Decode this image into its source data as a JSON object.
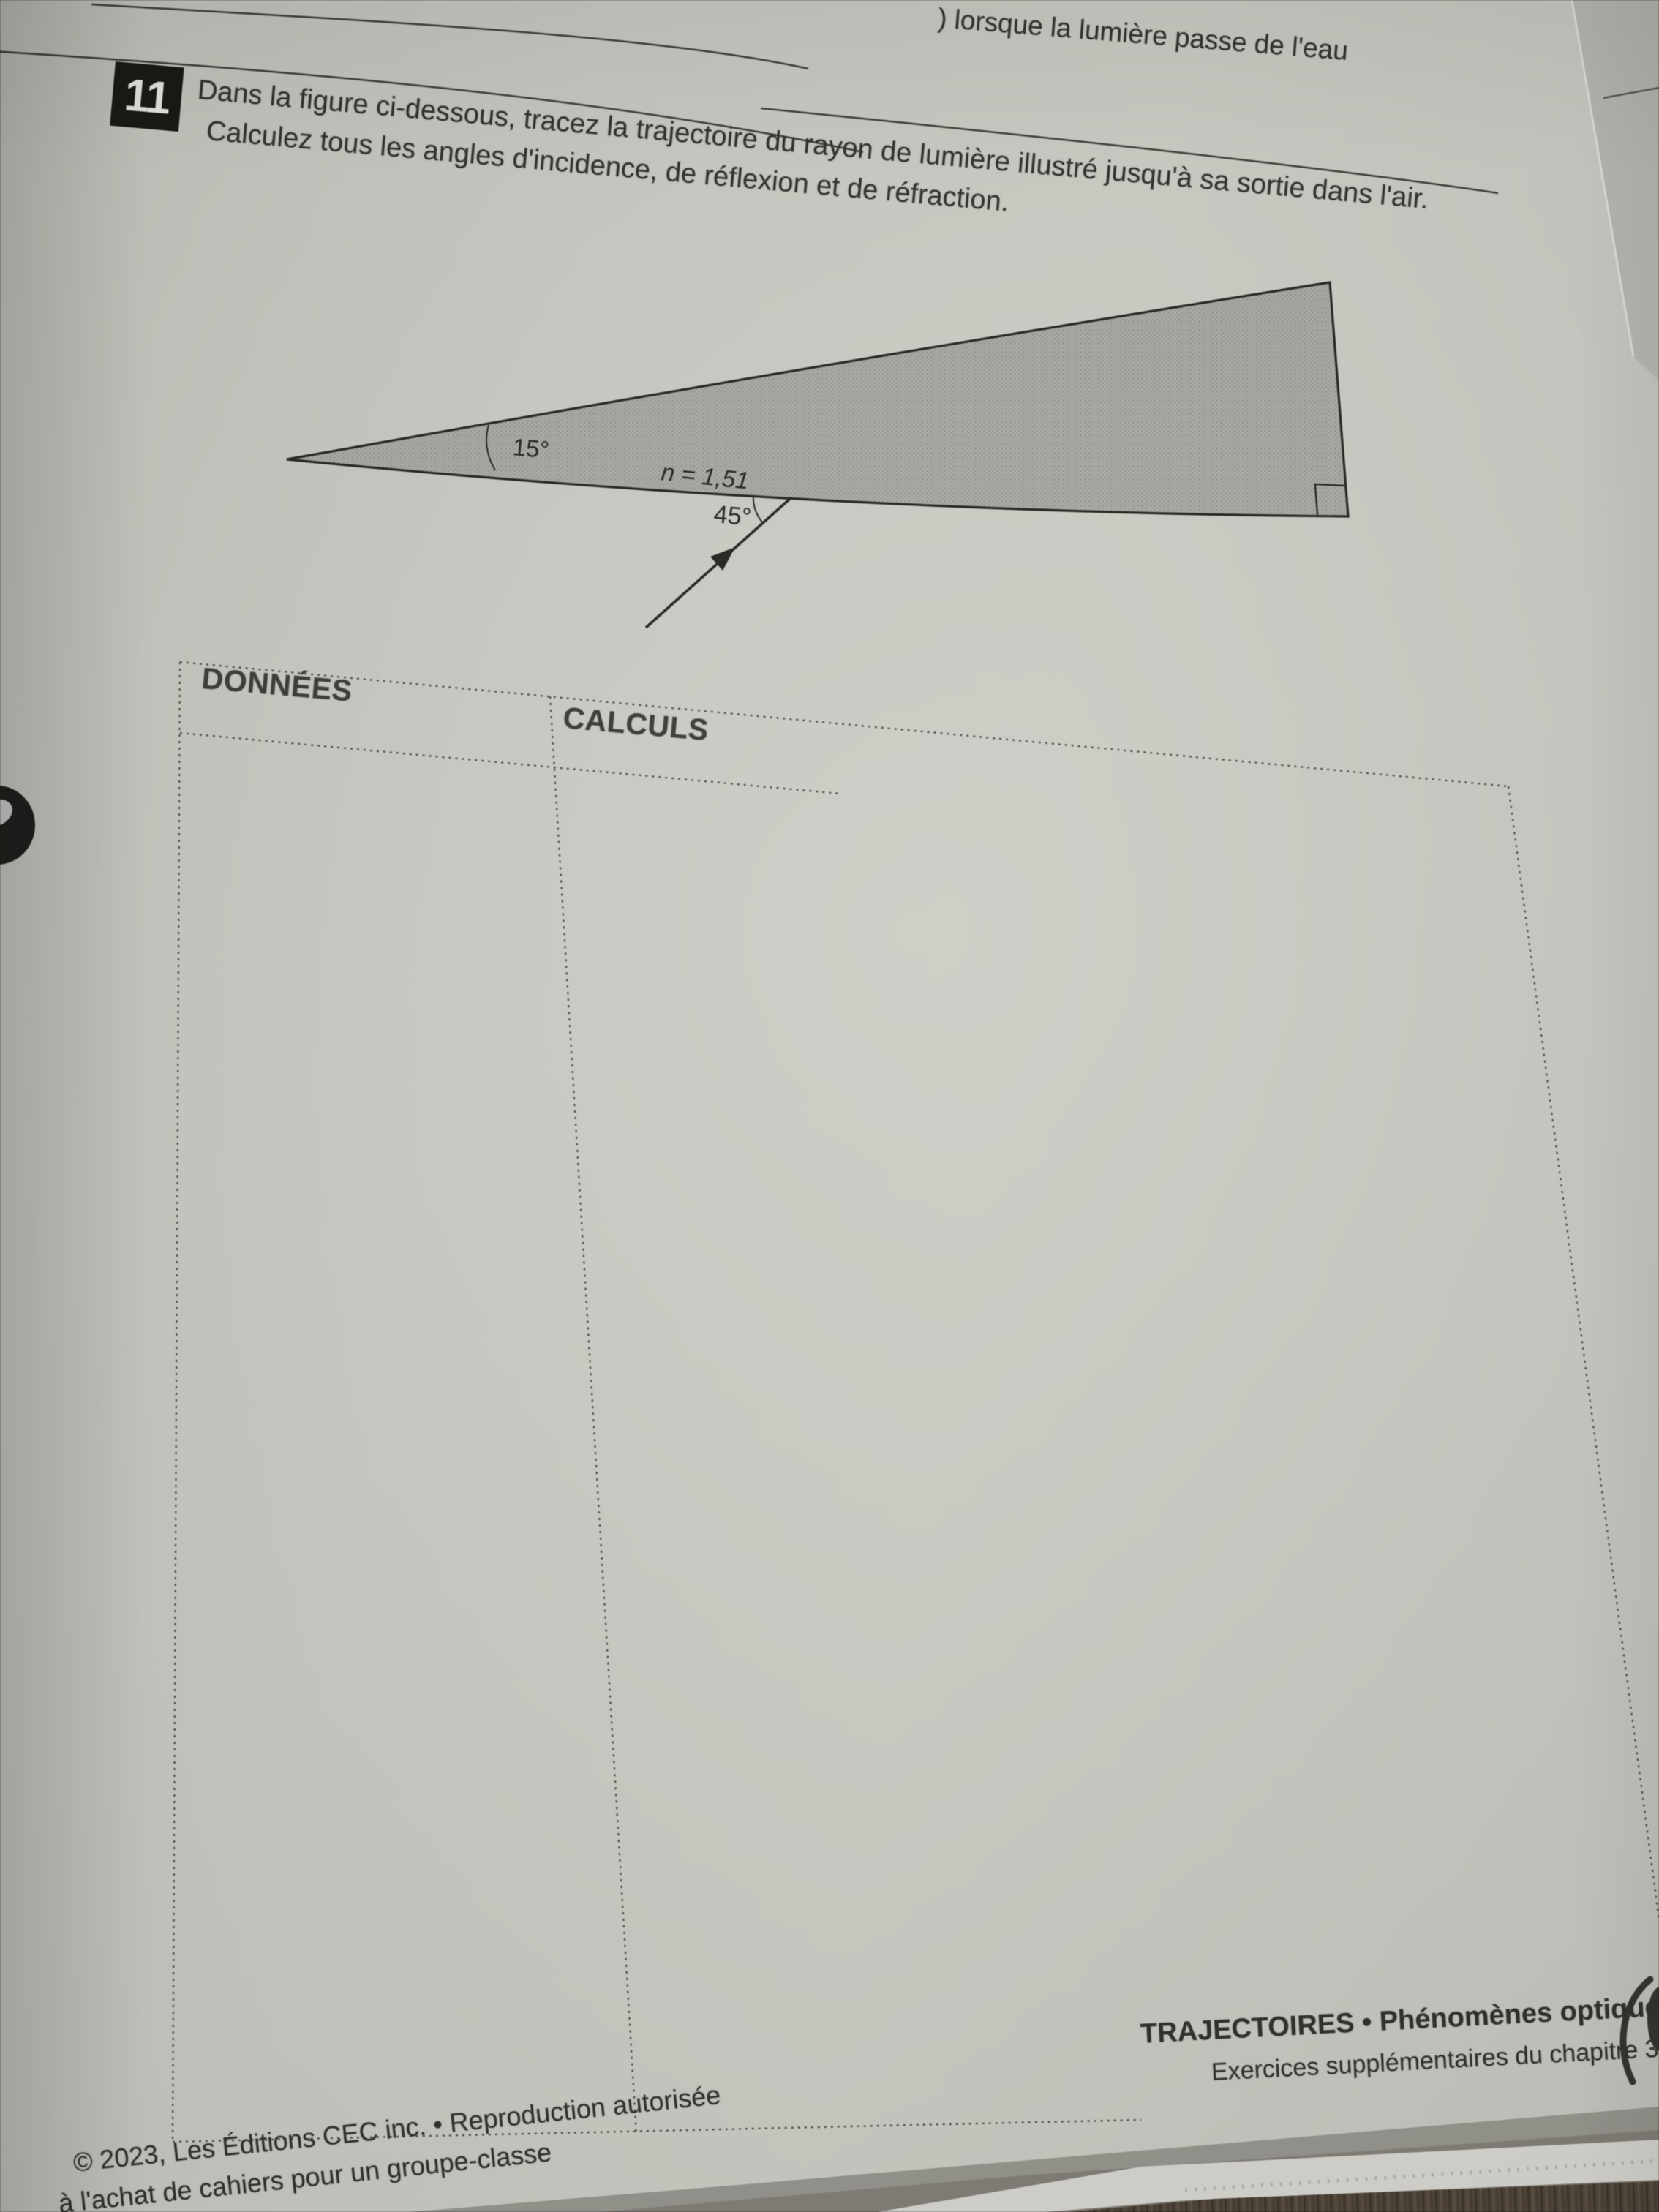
{
  "photo_top": {
    "previous_answer_fragment": ") lorsque la lumière passe de l'eau"
  },
  "exercise": {
    "number": "11",
    "statement_line1": "Dans la figure ci-dessous, tracez la trajectoire du rayon de lumière illustré jusqu'à sa sortie dans l'air.",
    "statement_line2": "Calculez tous les angles d'incidence, de réflexion et de réfraction."
  },
  "figure": {
    "apex_angle_label": "15°",
    "index_label": "n = 1,51",
    "incidence_angle_label": "45°"
  },
  "worktable": {
    "left_header": "DONNÉES",
    "right_header": "CALCULS"
  },
  "footer": {
    "copyright_line1": "© 2023, Les Éditions CEC inc. • Reproduction autorisée",
    "copyright_line2": "à l'achat de cahiers pour un groupe-classe",
    "section_line1": "TRAJECTOIRES • Phénomènes optiques",
    "section_line2": "Exercices supplémentaires du chapitre 3"
  },
  "colors": {
    "paper": "#c9c8c1",
    "ink": "#2e2c28",
    "prism_fill": "#abaaa4",
    "prism_dots": "#8e8d87",
    "dashed_line": "#45443f",
    "under_page": "#b8b7b1",
    "stack_edge": "#d8d7d2",
    "wood_table": "#4e4337"
  }
}
